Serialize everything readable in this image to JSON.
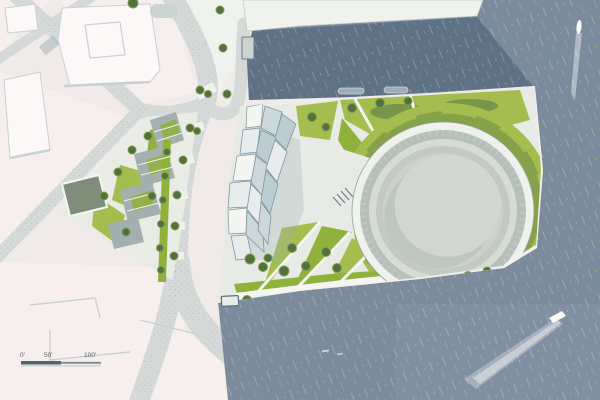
{
  "scale_bar": {
    "labels": [
      "0'",
      "50'",
      "100'"
    ]
  },
  "colors": {
    "city_base": "#f0eae9",
    "city_block": "#f6efee",
    "building_white": "#fbf8f7",
    "building_shadow": "#c7d1d4",
    "road": "#d5dad9",
    "road_dark": "#b9c4c6",
    "quay": "#f0f2ee",
    "plaza": "#e8ebe5",
    "path_white": "#f4f6f1",
    "water": "#7b8b9c",
    "water_basin": "#5f7184",
    "lawn": "#a3bd4e",
    "lawn_bright": "#8fb23c",
    "hedge": "#6d8c49",
    "tree": "#53713f",
    "tree_light": "#7f9c52",
    "green_roof": "#7e8e7b",
    "roof_gray": "#a2b1af",
    "panel_light": "#e7edec",
    "panel_mid": "#ccd8da",
    "panel_dark": "#bccdd1",
    "panel_outline": "#7f97a1",
    "arena_walk": "#eff1ec",
    "arena_ring": "#b6c0ba",
    "arena_ring_light": "#d6dbd4",
    "arena_ring_mid": "#c2cac3",
    "arena_dish": "#ccd2cb",
    "arena_shadow": "#bdc6bf",
    "arena_dish_light": "#d1d7d0",
    "boat_white": "#fafcfa",
    "scalebar_dark": "#51636b",
    "scalebar_mid": "#7e8f96",
    "label": "#4e6069"
  }
}
